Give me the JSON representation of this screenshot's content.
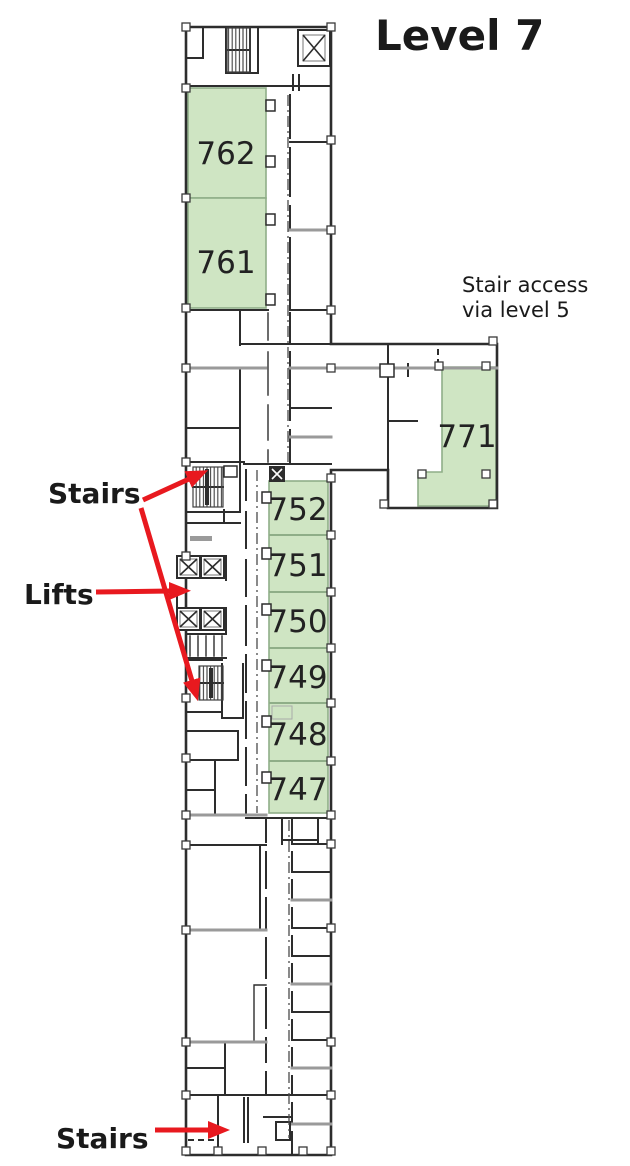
{
  "title": "Level 7",
  "labels": {
    "stairs_top": "Stairs",
    "lifts": "Lifts",
    "stairs_bottom": "Stairs",
    "stair_access_line1": "Stair access",
    "stair_access_line2": "via level 5"
  },
  "rooms": {
    "left_block": [
      {
        "number": "762"
      },
      {
        "number": "761"
      }
    ],
    "wing": [
      {
        "number": "771"
      }
    ],
    "right_column": [
      {
        "number": "752"
      },
      {
        "number": "751"
      },
      {
        "number": "750"
      },
      {
        "number": "749"
      },
      {
        "number": "748"
      },
      {
        "number": "747"
      }
    ]
  },
  "icons": {
    "lift_shaft": "lift-shaft-x-icon",
    "stairs": "stair-hatch-icon",
    "service_riser": "riser-x-icon",
    "arrow": "red-pointer-arrow-icon"
  },
  "colors": {
    "room_highlight": "#cfe5c3",
    "room_border": "#8fae88",
    "arrow": "#e8191f",
    "wall": "#2d2d2d",
    "wall_gray": "#9a9a9a",
    "text": "#1a1a1a",
    "background": "#ffffff"
  }
}
